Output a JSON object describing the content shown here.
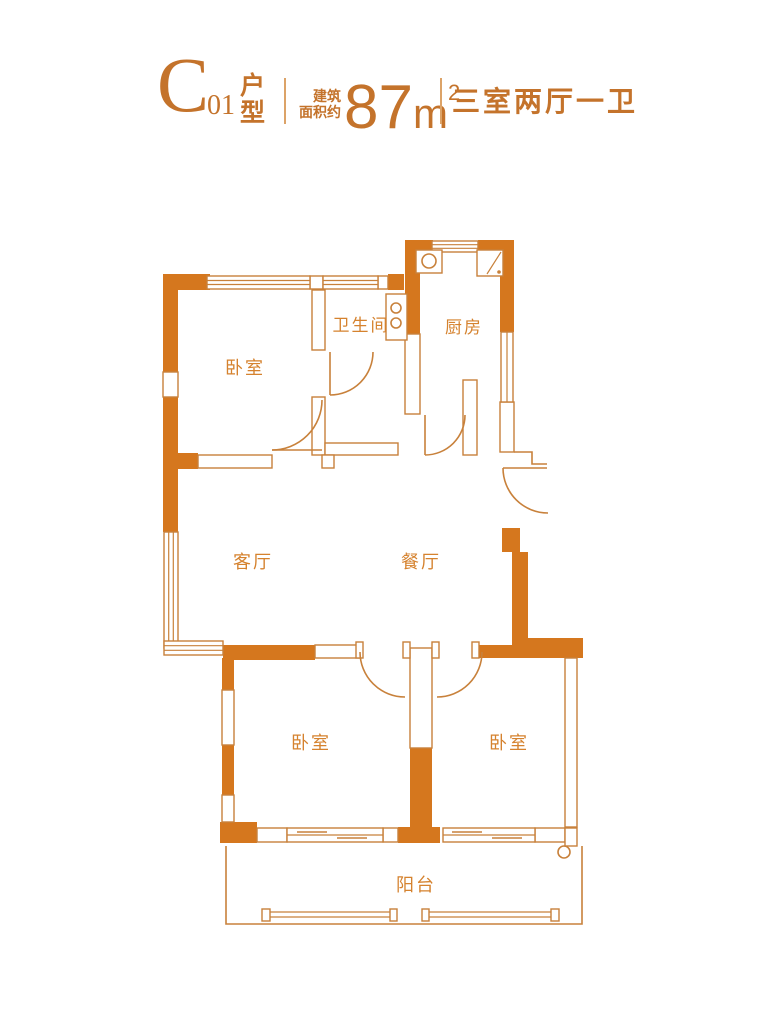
{
  "header": {
    "plan_letter": "C",
    "plan_number": "01",
    "plan_type_top": "户",
    "plan_type_bottom": "型",
    "area_label_line1": "建筑",
    "area_label_line2": "面积约",
    "area_value": "87",
    "area_unit": "m",
    "area_sup": "2",
    "layout_summary": "三室两厅一卫"
  },
  "floorplan": {
    "rooms": [
      {
        "id": "bedroom-north",
        "label": "卧室"
      },
      {
        "id": "bathroom",
        "label": "卫生间"
      },
      {
        "id": "kitchen",
        "label": "厨房"
      },
      {
        "id": "living-room",
        "label": "客厅"
      },
      {
        "id": "dining-room",
        "label": "餐厅"
      },
      {
        "id": "bedroom-southwest",
        "label": "卧室"
      },
      {
        "id": "bedroom-southeast",
        "label": "卧室"
      },
      {
        "id": "balcony",
        "label": "阳台"
      }
    ],
    "colors": {
      "wall": "#D5771E",
      "line": "#C8813B",
      "label": "#D5822E",
      "header_text": "#C4732B"
    }
  }
}
